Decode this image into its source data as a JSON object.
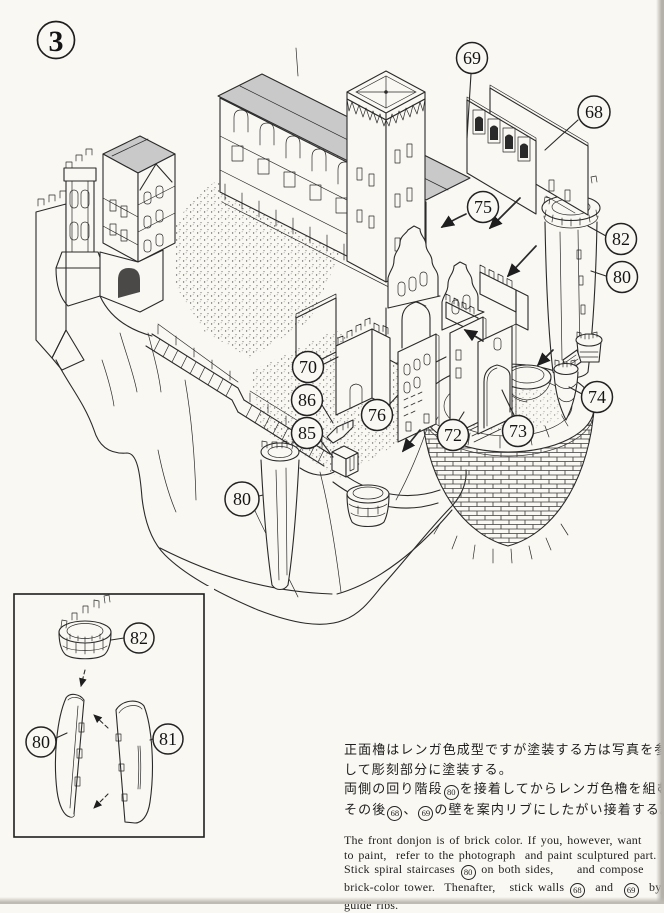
{
  "page": {
    "step_number": "3"
  },
  "main_diagram": {
    "callouts": [
      {
        "part": "wall-panel-front",
        "label": "69"
      },
      {
        "part": "wall-panel-rear",
        "label": "68"
      },
      {
        "part": "guide-rib-position",
        "label": "75"
      },
      {
        "part": "tower-crown",
        "label": "82"
      },
      {
        "part": "tower-shell-right",
        "label": "80"
      },
      {
        "part": "bent-crenellated-wall",
        "label": "70"
      },
      {
        "part": "stair-wedge",
        "label": "86"
      },
      {
        "part": "channel-block",
        "label": "85"
      },
      {
        "part": "window-wall",
        "label": "76"
      },
      {
        "part": "gate-wall",
        "label": "72"
      },
      {
        "part": "arch-wall",
        "label": "73"
      },
      {
        "part": "twin-turret",
        "label": "74"
      },
      {
        "part": "tower-shell-bottom",
        "label": "80"
      }
    ]
  },
  "inset_diagram": {
    "callouts": [
      {
        "part": "tower-crown",
        "label": "82"
      },
      {
        "part": "tower-shell-left",
        "label": "80"
      },
      {
        "part": "tower-shell-right",
        "label": "81"
      }
    ]
  },
  "instructions": {
    "jp": [
      [
        {
          "t": "正面櫓はレンガ色成型ですが塗装する方は写真を参考に"
        }
      ],
      [
        {
          "t": "して彫刻部分に塗装する。"
        }
      ],
      [
        {
          "t": "両側の回り階段"
        },
        {
          "c": "80"
        },
        {
          "t": "を接着してからレンガ色櫓を組む。"
        }
      ],
      [
        {
          "t": "その後"
        },
        {
          "c": "68"
        },
        {
          "t": "、"
        },
        {
          "c": "69"
        },
        {
          "t": "の壁を案内リブにしたがい接着する。"
        }
      ]
    ],
    "en": [
      [
        {
          "t": "The front donjon is of brick color. If you, however, want"
        }
      ],
      [
        {
          "t": "to paint,  refer to the photograph  and paint sculptured part."
        }
      ],
      [
        {
          "t": "Stick spiral staircases "
        },
        {
          "c": "80"
        },
        {
          "t": " on both sides,     and compose"
        }
      ],
      [
        {
          "t": "brick-color tower.  Thenafter,   stick walls "
        },
        {
          "c": "68"
        },
        {
          "t": "  and  "
        },
        {
          "c": "69"
        },
        {
          "t": "  by"
        }
      ],
      [
        {
          "t": "guide ribs."
        }
      ]
    ]
  }
}
